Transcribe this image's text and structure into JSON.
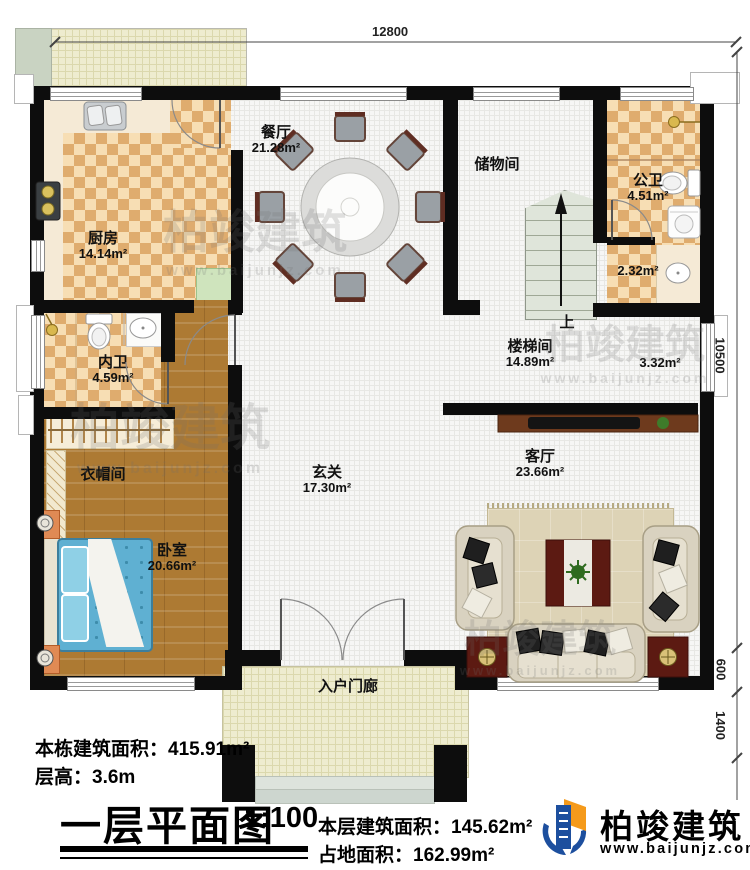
{
  "meta": {
    "plan_title": "一层平面图",
    "scale": "1:100",
    "stair_up_label": "上"
  },
  "dimensions": {
    "top_width": "12800",
    "right_height": "10500",
    "right_porch": "600",
    "right_steps": "1400"
  },
  "rooms": {
    "kitchen": {
      "name": "厨房",
      "area": "14.14m²"
    },
    "dining": {
      "name": "餐厅",
      "area": "21.28m²"
    },
    "storage": {
      "name": "储物间"
    },
    "public_bath": {
      "name": "公卫",
      "area": "4.51m²"
    },
    "wash_area": {
      "area": "2.32m²"
    },
    "private_bath": {
      "name": "内卫",
      "area": "4.59m²"
    },
    "stairwell": {
      "name": "楼梯间",
      "area": "14.89m²",
      "annex_area": "3.32m²"
    },
    "foyer": {
      "name": "玄关",
      "area": "17.30m²"
    },
    "cloakroom": {
      "name": "衣帽间"
    },
    "bedroom": {
      "name": "卧室",
      "area": "20.66m²"
    },
    "living": {
      "name": "客厅",
      "area": "23.66m²"
    },
    "porch": {
      "name": "入户门廊"
    }
  },
  "title_block": {
    "building_area": "本栋建筑面积：415.91m²",
    "floor_height": "层高：3.6m",
    "floor_area": "本层建筑面积：145.62m²",
    "footprint_area": "占地面积：162.99m²"
  },
  "brand": {
    "name": "柏竣建筑",
    "website": "www.baijunjz.com"
  },
  "watermark": {
    "text": "柏竣建筑",
    "website": "www.baijunjz.com"
  },
  "colors": {
    "wall": "#0d0d0d",
    "tile_dark": "#dfac6e",
    "tile_light": "#f7deb4",
    "wood": "#ad7a33",
    "brand_blue": "#1d4f9e",
    "brand_orange": "#f59a1b"
  }
}
